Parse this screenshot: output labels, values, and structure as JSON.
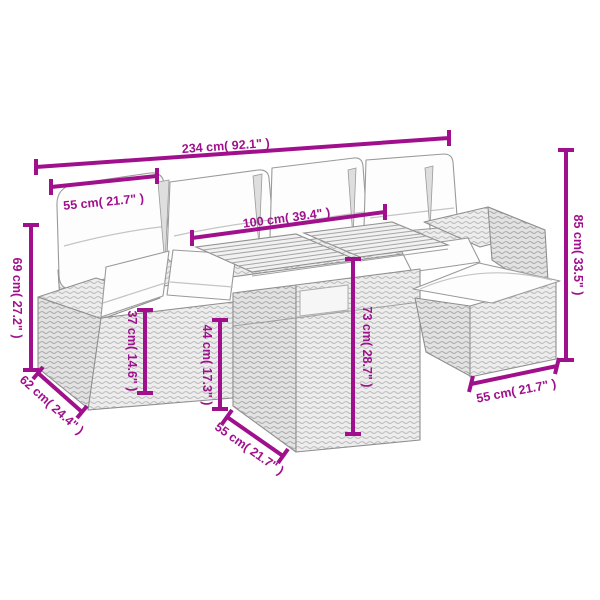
{
  "diagram": {
    "kind": "product-dimension-diagram",
    "subject": "poly rattan garden furniture set line drawing: sofa with back pillows, slatted-top table, footstool with cushions",
    "accent_color": "#A0108C",
    "line_art_color": "#8f8f8f",
    "background_color": "#ffffff",
    "dimensions": [
      {
        "name": "total width",
        "cm": 234,
        "inches": 92.1,
        "orientation": "horizontal",
        "label": "234 cm( 92.1\" )"
      },
      {
        "name": "seat width",
        "cm": 55,
        "inches": 21.7,
        "orientation": "horizontal",
        "label": "55 cm( 21.7\" )"
      },
      {
        "name": "table length",
        "cm": 100,
        "inches": 39.4,
        "orientation": "horizontal",
        "label": "100 cm( 39.4\" )"
      },
      {
        "name": "backrest height",
        "cm": 85,
        "inches": 33.5,
        "orientation": "vertical",
        "label": "85 cm( 33.5\" )"
      },
      {
        "name": "armrest height",
        "cm": 69,
        "inches": 27.2,
        "orientation": "vertical",
        "label": "69 cm( 27.2\" )"
      },
      {
        "name": "seat height",
        "cm": 37,
        "inches": 14.6,
        "orientation": "vertical",
        "label": "37 cm( 14.6\" )"
      },
      {
        "name": "stool height",
        "cm": 44,
        "inches": 17.3,
        "orientation": "vertical",
        "label": "44 cm( 17.3\" )"
      },
      {
        "name": "table height",
        "cm": 73,
        "inches": 28.7,
        "orientation": "vertical",
        "label": "73 cm( 28.7\" )"
      },
      {
        "name": "sofa depth",
        "cm": 62,
        "inches": 24.4,
        "orientation": "diagonal",
        "label": "62 cm( 24.4\" )"
      },
      {
        "name": "table depth",
        "cm": 55,
        "inches": 21.7,
        "orientation": "diagonal",
        "label": "55 cm( 21.7\" )"
      },
      {
        "name": "stool width",
        "cm": 55,
        "inches": 21.7,
        "orientation": "diagonal",
        "label": "55 cm( 21.7\" )"
      }
    ]
  }
}
